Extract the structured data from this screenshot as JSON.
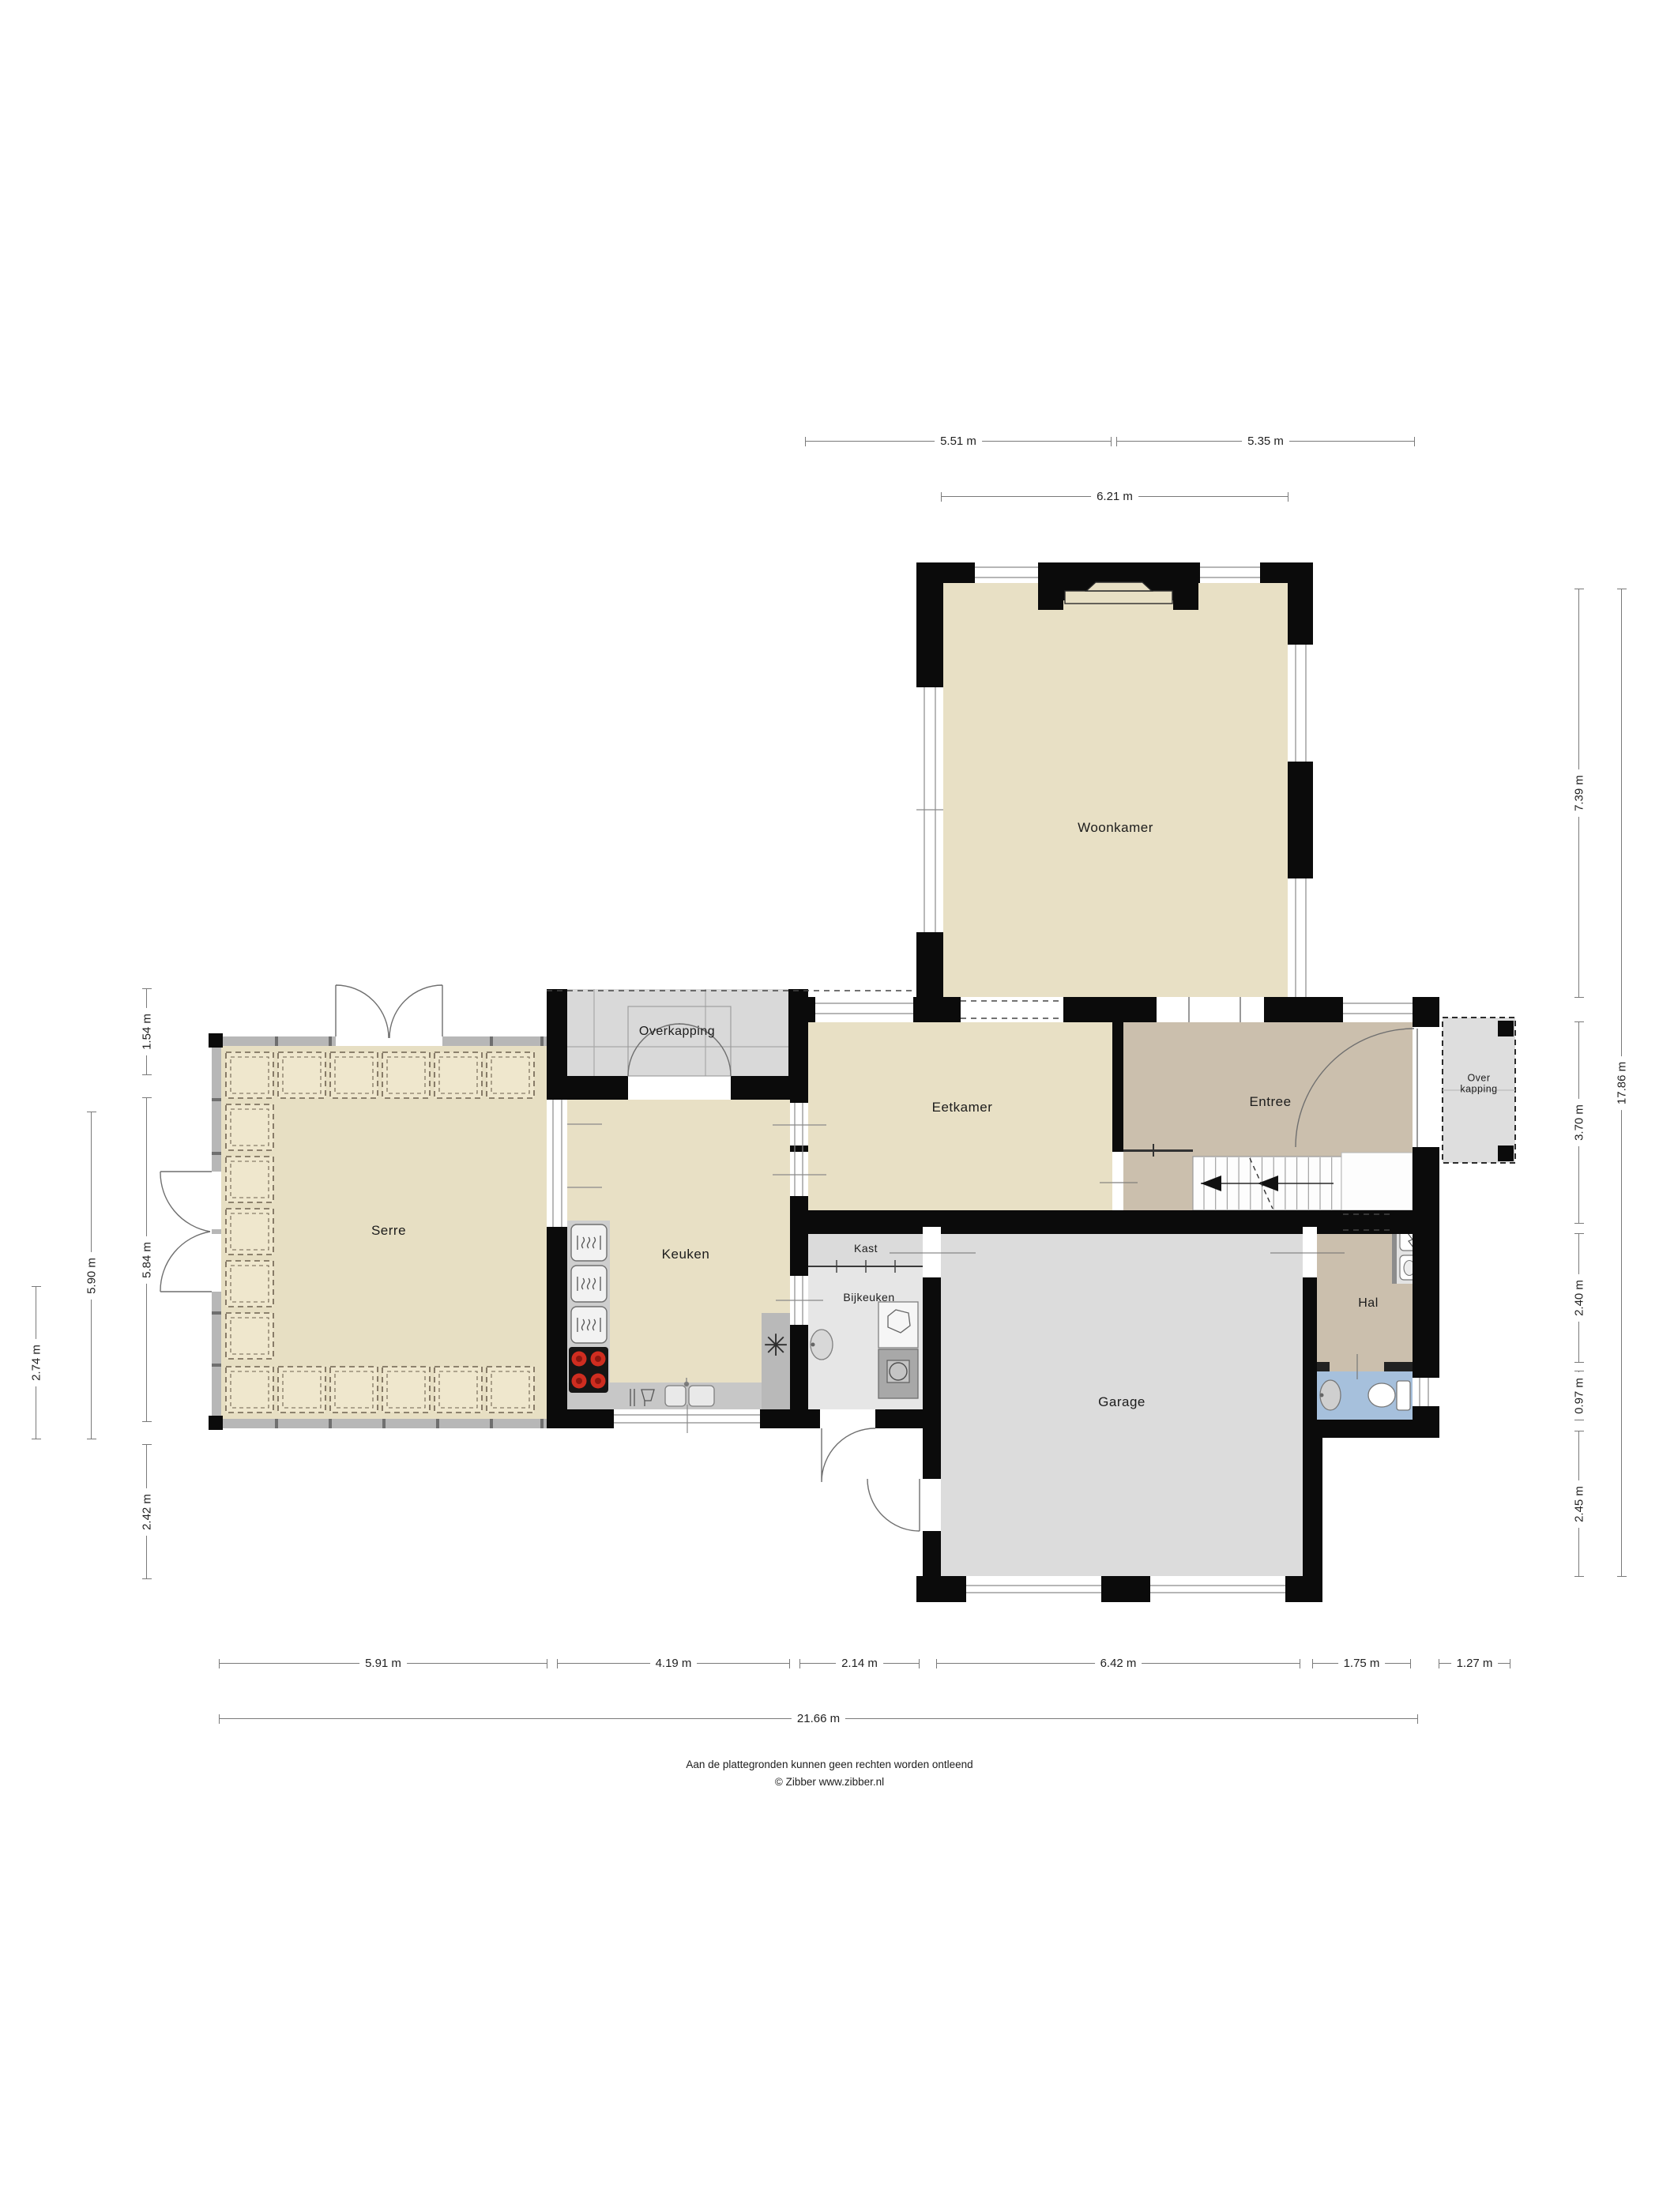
{
  "rooms": {
    "woonkamer": "Woonkamer",
    "eetkamer": "Eetkamer",
    "entree": "Entree",
    "overkapping_top": "Overkapping",
    "overkapping_right_line1": "Over",
    "overkapping_right_line2": "kapping",
    "serre": "Serre",
    "keuken": "Keuken",
    "kast": "Kast",
    "bijkeuken": "Bijkeuken",
    "hal": "Hal",
    "garage": "Garage"
  },
  "dimensions": {
    "top": [
      "5.51 m",
      "5.35 m",
      "6.21 m"
    ],
    "bottom": [
      "5.91 m",
      "4.19 m",
      "2.14 m",
      "6.42 m",
      "1.75 m",
      "1.27 m"
    ],
    "bottom_total": "21.66 m",
    "left": [
      "1.54 m",
      "5.84 m",
      "2.42 m",
      "5.90 m",
      "2.74 m"
    ],
    "right": [
      "7.39 m",
      "3.70 m",
      "2.40 m",
      "0.97 m",
      "2.45 m",
      "17.86 m"
    ]
  },
  "footer": {
    "disclaimer": "Aan de plattegronden kunnen geen rechten worden ontleend",
    "credit": "© Zibber www.zibber.nl"
  },
  "icons": {
    "freezer_symbol": "✳"
  },
  "colors": {
    "floor_living": "#e8e0c5",
    "floor_hall": "#cbbfad",
    "floor_wc": "#a6c0dc",
    "floor_garage": "#dcdcdc",
    "wall": "#0b0b0b",
    "dimension_line": "#7a7a7a",
    "burner_red": "#cf2d20"
  }
}
